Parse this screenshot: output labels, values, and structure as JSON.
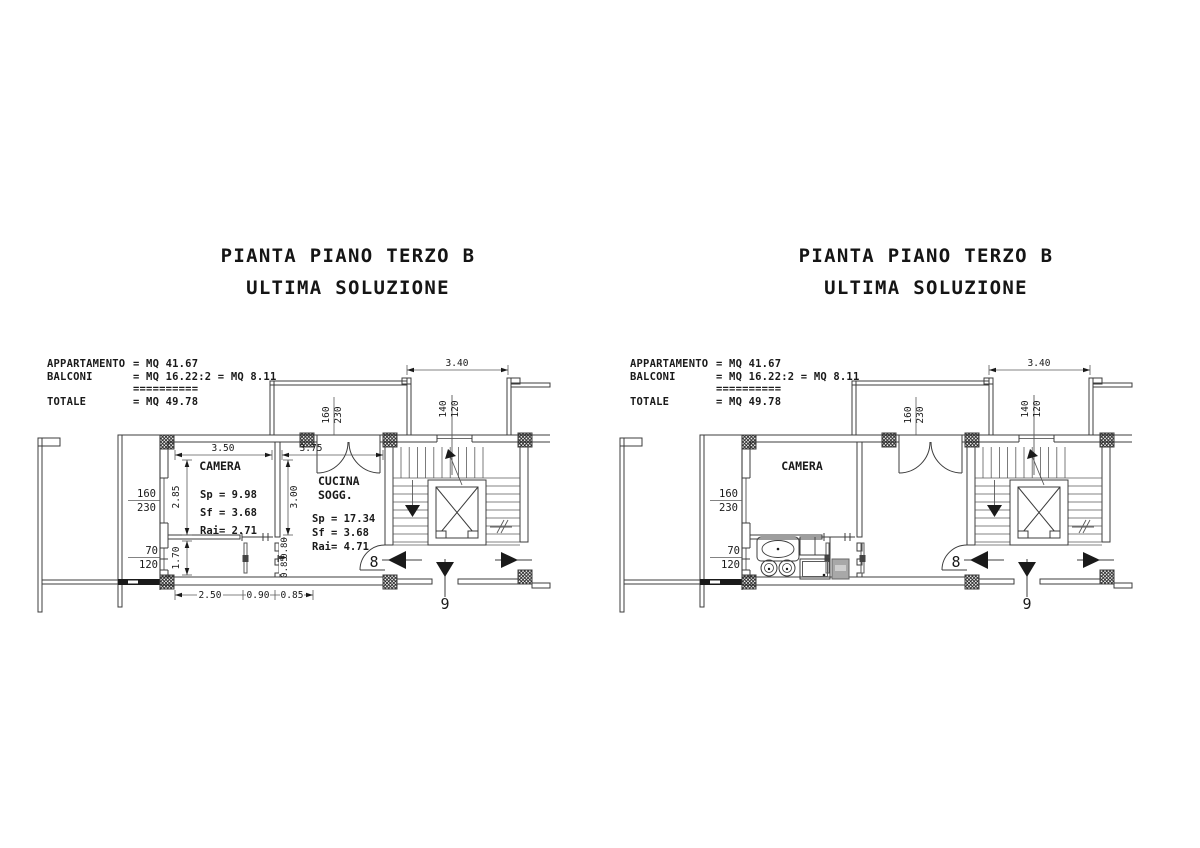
{
  "colors": {
    "drawing_line": "#3c3c3c",
    "dim_line": "#5a5a5a",
    "text": "#1a1a1a",
    "washer_fill": "#a8a8a8"
  },
  "titles": {
    "line1": "PIANTA PIANO TERZO B",
    "line2": "ULTIMA SOLUZIONE"
  },
  "area_table": {
    "rows": [
      {
        "label": "APPARTAMENTO",
        "value": "= MQ 41.67"
      },
      {
        "label": "BALCONI",
        "value": "= MQ 16.22:2 = MQ 8.11"
      },
      {
        "label": "",
        "value": "=========="
      },
      {
        "label": "TOTALE",
        "value": "= MQ 49.78"
      }
    ]
  },
  "rooms": {
    "camera": {
      "name": "CAMERA",
      "sp": "Sp = 9.98",
      "sf": "Sf = 3.68",
      "rai": "Rai= 2.71"
    },
    "cucina": {
      "name_line1": "CUCINA",
      "name_line2": "SOGG.",
      "sp": "Sp = 17.34",
      "sf": "Sf =  3.68",
      "rai": "Rai=  4.71"
    }
  },
  "dimensions": {
    "balcony_width": "3.40",
    "camera_width": "3.50",
    "cucina_width": "3.75",
    "camera_depth": "2.85",
    "cucina_depth": "3.00",
    "bagno_depth": "1.70",
    "door_080": "0.80",
    "door_085": "0.85",
    "bottom_250": "2.50",
    "bottom_090": "0.90",
    "bottom_085": "0.85"
  },
  "openings": {
    "top_door": {
      "w": "160",
      "h": "230"
    },
    "stair_window": {
      "w": "140",
      "h": "120"
    },
    "camera_window": {
      "w": "160",
      "h": "230"
    },
    "small_window": {
      "w": "70",
      "h": "120"
    }
  },
  "door_numbers": {
    "door8": "8",
    "door9": "9"
  },
  "plans": [
    {
      "name": "floor-plan-left",
      "show_dimensions": true,
      "show_fixtures": false
    },
    {
      "name": "floor-plan-right",
      "show_dimensions": false,
      "show_fixtures": true
    }
  ]
}
